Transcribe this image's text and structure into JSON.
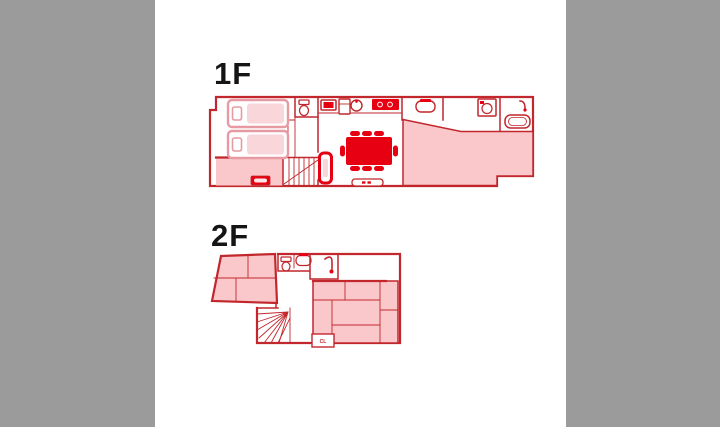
{
  "page": {
    "kind": "floor-plan-diagram",
    "background": "#ffffff"
  },
  "colors": {
    "sidebar": "#9b9b9b",
    "bg": "#ffffff",
    "wall": "#c1272d",
    "accent": "#e60012",
    "roomfill": "#fac8ca",
    "bedstroke": "#e89aa2",
    "bedfill": "#f8d6da",
    "label": "#151515"
  },
  "labels": {
    "floor1": "1F",
    "floor2": "2F",
    "closet": "CL"
  },
  "floors": [
    {
      "label": "1F",
      "fixtures": [
        "twin-beds",
        "entry-storage",
        "staircase",
        "toilet",
        "tv",
        "refrigerator",
        "kitchen-sink",
        "stove",
        "dining-table-8-seats",
        "sofa",
        "tv-console",
        "vanity-sink",
        "washing-machine",
        "bathtub",
        "large-bedroom"
      ]
    },
    {
      "label": "2F",
      "fixtures": [
        "tatami-room-small",
        "toilet",
        "vanity-sink",
        "shower",
        "balcony",
        "tatami-room-large",
        "closet-CL",
        "winder-staircase"
      ]
    }
  ]
}
